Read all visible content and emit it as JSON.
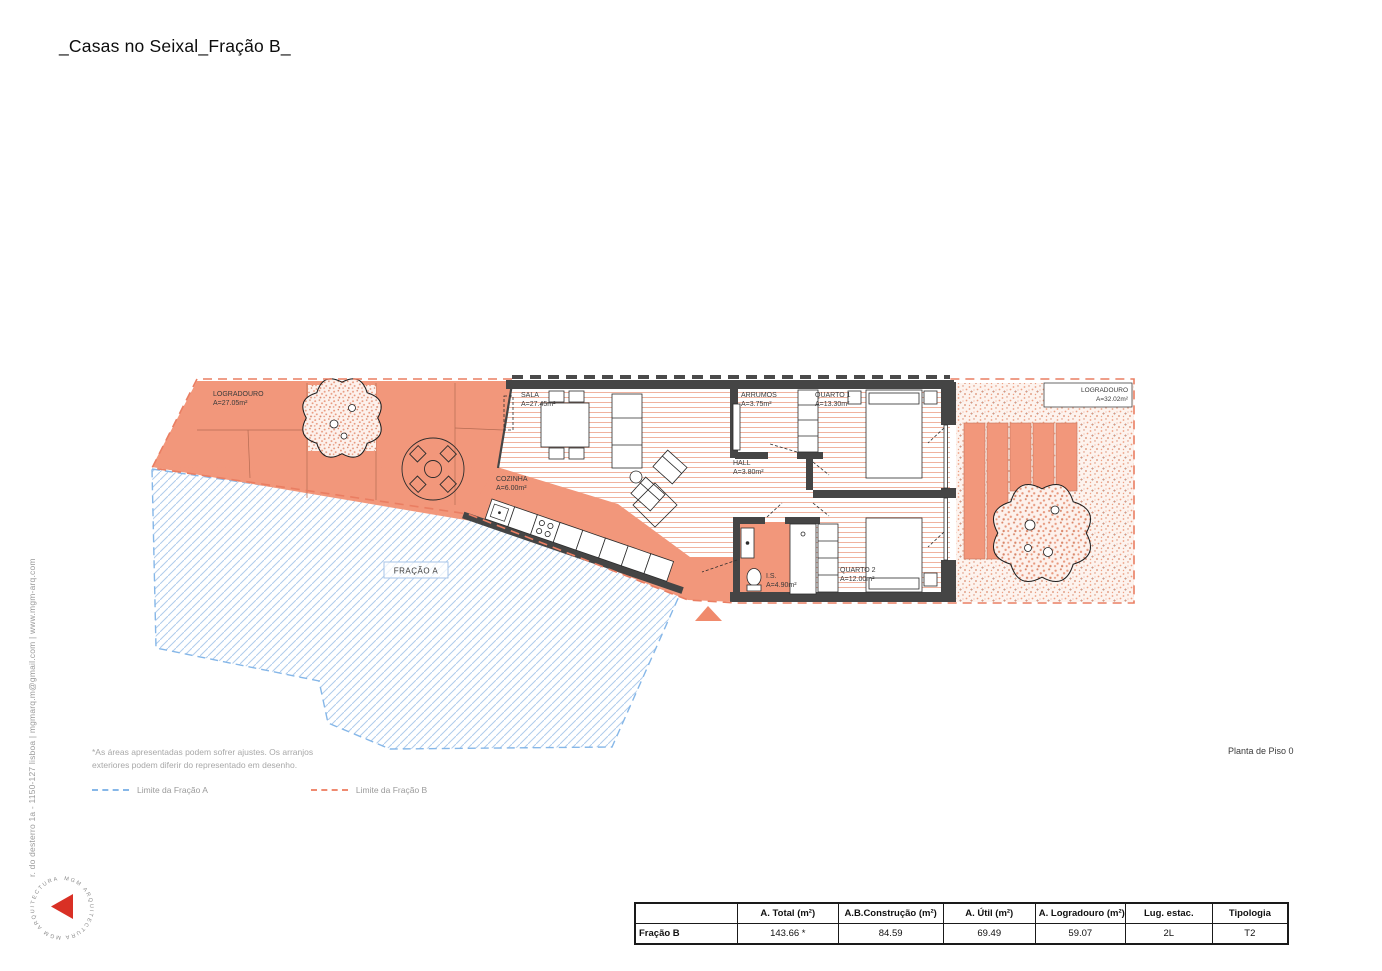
{
  "title": "_Casas no Seixal_Fração B_",
  "contact": "r. do desterro 1a - 1150-127 lisboa | mgmarq.m@gmail.com | www.mgm-arq.com",
  "logo": {
    "circle_text": "MGM ARQUITECTURA      MGM ARQUITECTURA",
    "accent": "#D93025"
  },
  "plan": {
    "drawing_title": "Planta de Piso 0",
    "fracao_a_label": "FRAÇÃO A",
    "rooms": [
      {
        "id": "logradouro-left",
        "name": "LOGRADOURO",
        "area": "A=27.05m²"
      },
      {
        "id": "sala",
        "name": "SALA",
        "area": "A=27.45m²"
      },
      {
        "id": "cozinha",
        "name": "COZINHA",
        "area": "A=6.00m²"
      },
      {
        "id": "arrumos",
        "name": "ARRUMOS",
        "area": "A=3.75m²"
      },
      {
        "id": "quarto-1",
        "name": "QUARTO 1",
        "area": "A=13.30m²"
      },
      {
        "id": "hall",
        "name": "HALL",
        "area": "A=3.80m²"
      },
      {
        "id": "is",
        "name": "I.S.",
        "area": "A=4.90m²"
      },
      {
        "id": "quarto-2",
        "name": "QUARTO 2",
        "area": "A=12.00m²"
      },
      {
        "id": "logradouro-right",
        "name": "LOGRADOURO",
        "area": "A=32.02m²"
      }
    ]
  },
  "notes": {
    "line1": "*As áreas apresentadas podem sofrer ajustes. Os arranjos",
    "line2": "exteriores podem diferir do representado em desenho."
  },
  "legend": {
    "a": "Limite da Fração A",
    "b": "Limite da Fração B"
  },
  "table": {
    "headers": {
      "c0": "",
      "c1": "A. Total (m²)",
      "c2": "A.B.Construção (m²)",
      "c3": "A. Útil (m²)",
      "c4": "A. Logradouro (m²)",
      "c5": "Lug. estac.",
      "c6": "Tipologia"
    },
    "row": {
      "c0": "Fração B",
      "c1": "143.66 *",
      "c2": "84.59",
      "c3": "69.49",
      "c4": "59.07",
      "c5": "2L",
      "c6": "T2"
    }
  },
  "colors": {
    "salmon": "#F2977B",
    "limit_a": "#86B7E8",
    "limit_b": "#EA7E62",
    "wall": "#454545"
  }
}
